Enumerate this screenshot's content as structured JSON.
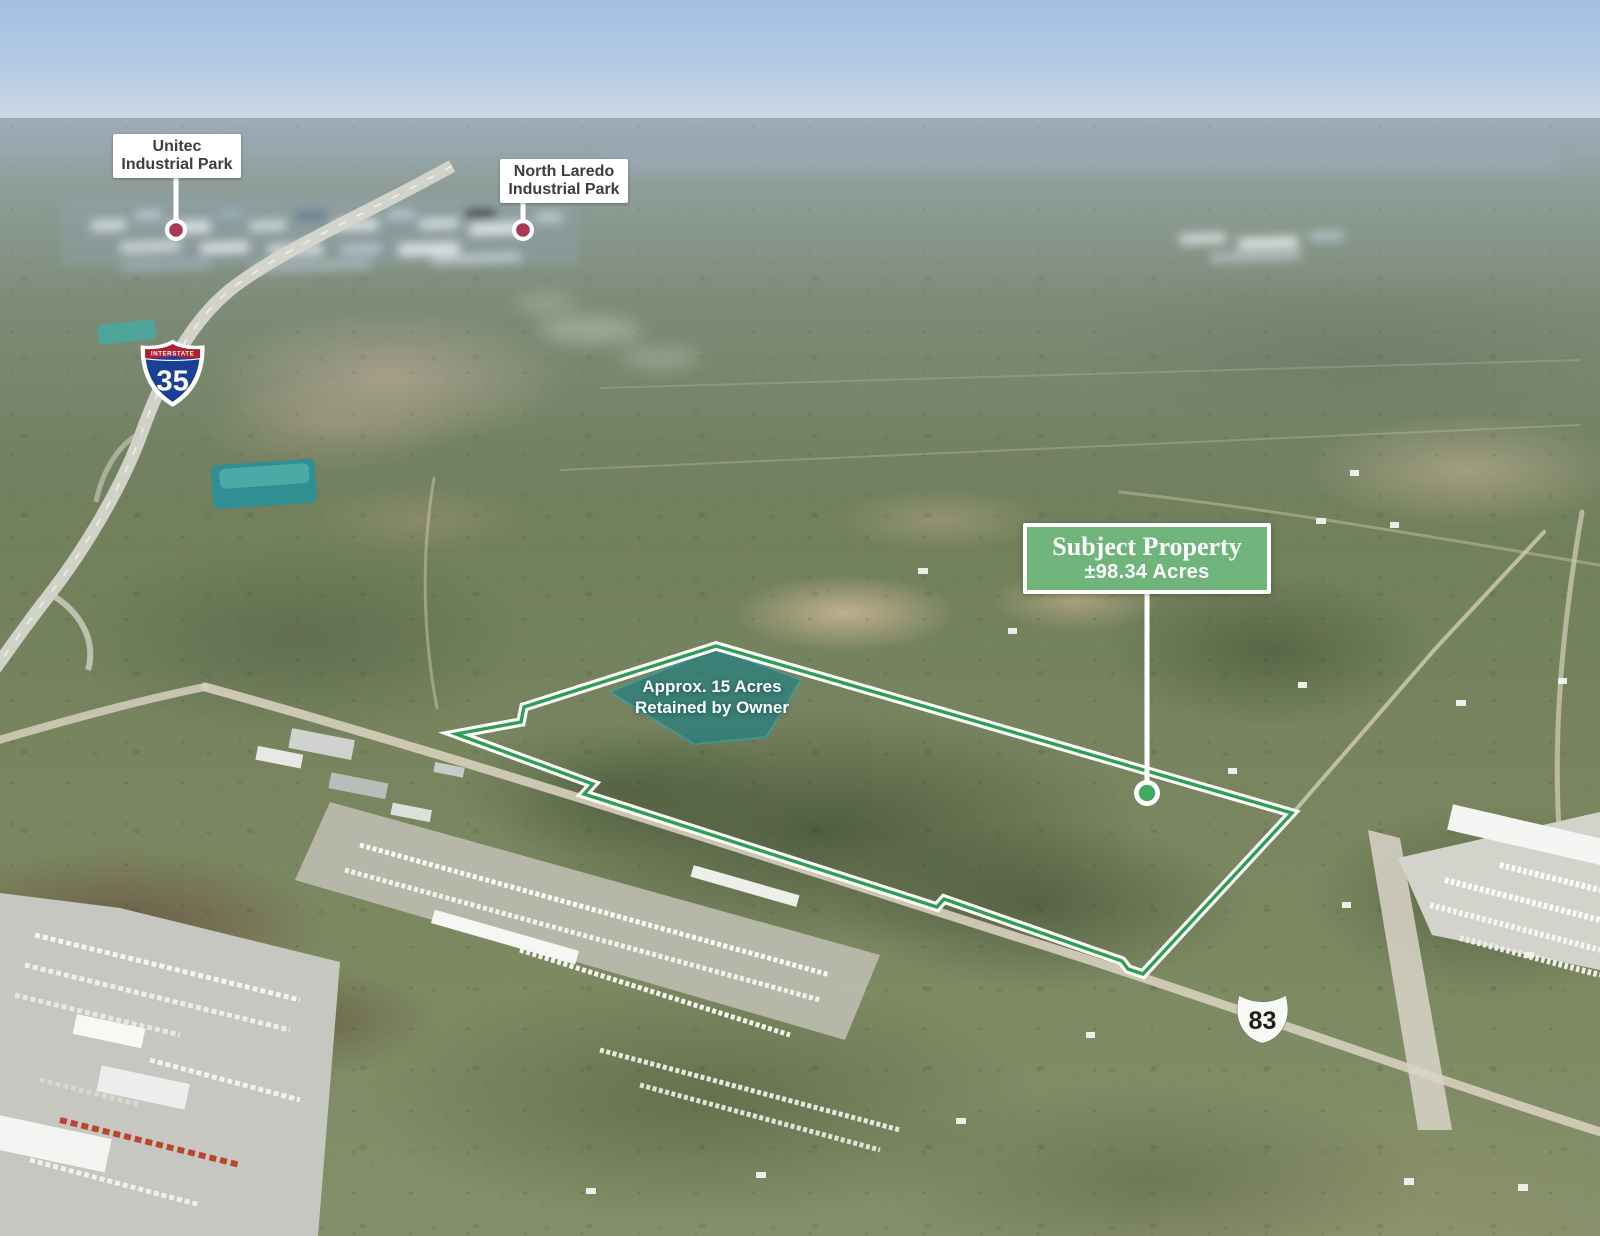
{
  "annotations": {
    "subject_property": {
      "title": "Subject Property",
      "acreage": "±98.34 Acres"
    },
    "retained_area": {
      "line1": "Approx. 15 Acres",
      "line2": "Retained by Owner"
    },
    "markers": [
      {
        "id": "unitec",
        "line1": "Unitec",
        "line2": "Industrial Park"
      },
      {
        "id": "north-laredo",
        "line1": "North Laredo",
        "line2": "Industrial Park"
      }
    ],
    "highway_shields": {
      "interstate": {
        "caption": "INTERSTATE",
        "number": "35"
      },
      "us_route": {
        "number": "83"
      }
    }
  },
  "colors": {
    "boundary_green": "#2f9e52",
    "boundary_casing": "#ffffff",
    "subject_box_green": "#6fb57b",
    "subject_dot_green": "#43a95e",
    "marker_dot_crimson": "#a63a55",
    "retained_fill_teal": "#0c7f8c",
    "label_text_dark": "#3c3c42",
    "interstate_blue": "#1b3f94",
    "interstate_red": "#b01f30"
  }
}
